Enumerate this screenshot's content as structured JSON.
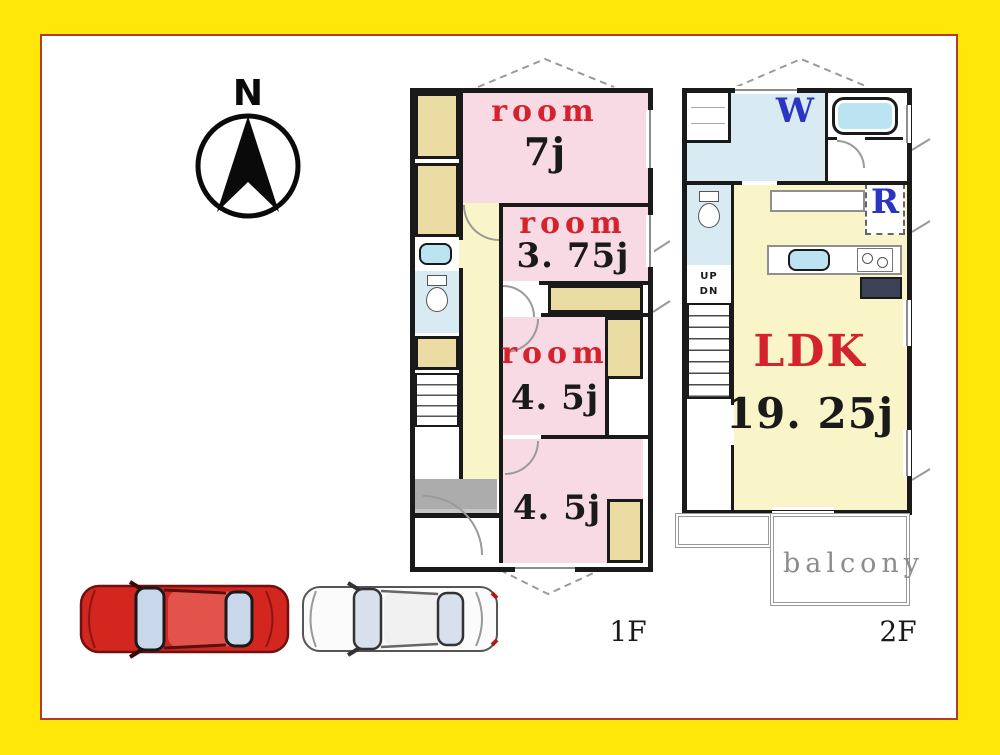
{
  "compass": {
    "north_label": "N"
  },
  "floor1": {
    "label": "1F",
    "rooms": {
      "room7": {
        "name": "room",
        "size": "7j"
      },
      "room375": {
        "name": "room",
        "size": "3. 75j"
      },
      "room45mid": {
        "name": "room",
        "size": "4. 5j"
      },
      "room45bottom": {
        "size": "4. 5j"
      }
    }
  },
  "floor2": {
    "label": "2F",
    "ldk": {
      "name": "LDK",
      "size": "19. 25j"
    },
    "washroom_label": "W",
    "refrigerator_label": "R",
    "stairs": {
      "up": "UP",
      "down": "DN"
    },
    "balcony_label": "balcony"
  },
  "colors": {
    "frame_yellow": "#FFE70A",
    "paper_border_red": "#B23A28",
    "wall_black": "#1A1A1A",
    "room_pink": "#F8DAE5",
    "hall_yellow": "#FAF5C9",
    "closet_tan": "#EBDCA4",
    "water_blue": "#D8EBF2",
    "fixture_blue": "#BCE3F2",
    "entrance_gray": "#ACACAC",
    "label_red": "#D5232E",
    "label_blue": "#2A35C2",
    "balcony_gray": "#8C8C8C",
    "car_red": "#D2261E",
    "car_white": "#FBFBFB"
  }
}
